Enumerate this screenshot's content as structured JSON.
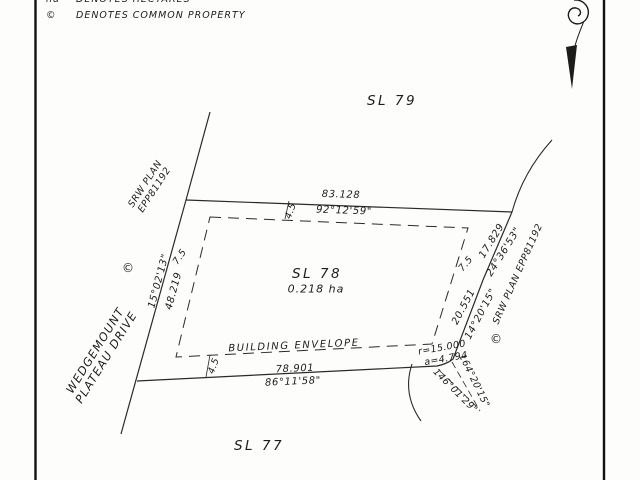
{
  "page": {
    "background": "#fdfdfc",
    "ink": "#1c1c1c"
  },
  "legend": {
    "rows": [
      {
        "symbol": "ha",
        "text": "DENOTES HECTARES"
      },
      {
        "symbol": "©",
        "text": "DENOTES COMMON PROPERTY"
      }
    ]
  },
  "icons": {
    "north_arrow": "ornamental-north-arrow"
  },
  "lots": {
    "sl79": "SL 79",
    "sl78": "SL 78",
    "sl78_area": "0.218 ha",
    "sl77": "SL 77"
  },
  "street": {
    "line1": "WEDGEMOUNT",
    "line2": "PLATEAU DRIVE"
  },
  "annotations": {
    "building_envelope": "BUILDING ENVELOPE",
    "srw_left_line1": "SRW PLAN",
    "srw_left_line2": "EPP81192",
    "srw_right": "SRW PLAN EPP81192",
    "common_property_left": "©",
    "common_property_right": "©"
  },
  "dimensions": {
    "top_length": "83.128",
    "top_bearing": "92°12'59\"",
    "bottom_length": "78.901",
    "bottom_bearing": "86°11'58\"",
    "left_bearing": "15°02'13\"",
    "left_length": "48.219",
    "right_upper_length": "17.829",
    "right_upper_bearing": "24°36'53\"",
    "right_lower_length": "20.551",
    "right_lower_bearing": "14°20'15\"",
    "corner_radius": "r=15.000",
    "corner_arc": "a=4.794",
    "corner_bearing_a": "164°20'15\"",
    "corner_bearing_b": "146°01'29\""
  },
  "setbacks": {
    "top": "4.5",
    "bottom": "4.5",
    "left": "7.5",
    "right": "7.5"
  }
}
